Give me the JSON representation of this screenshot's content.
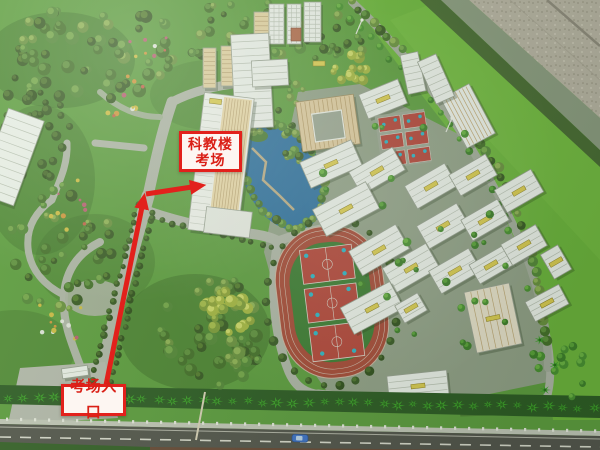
{
  "annotations": {
    "building_label": {
      "line1": "科教楼",
      "line2": "考场"
    },
    "entrance_label": {
      "text": "考场入口"
    }
  },
  "colors": {
    "accent": "#e2211c",
    "label-bg": "#fdf6f2",
    "label-text": "#da1f16",
    "grass": "#5e9c40",
    "field-green": "#6db33e",
    "pond-blue": "#2e6f9e",
    "track-red": "#a64a38",
    "court-red": "#b3453a",
    "court-blue": "#2fb3c4",
    "building-white": "#eaeee8",
    "tan-building": "#dcc89e",
    "floor-gray": "#b6b1a2",
    "road-gray": "#aeb4a6",
    "asphalt": "#55564e",
    "hedge-dark": "#2f5c26"
  }
}
